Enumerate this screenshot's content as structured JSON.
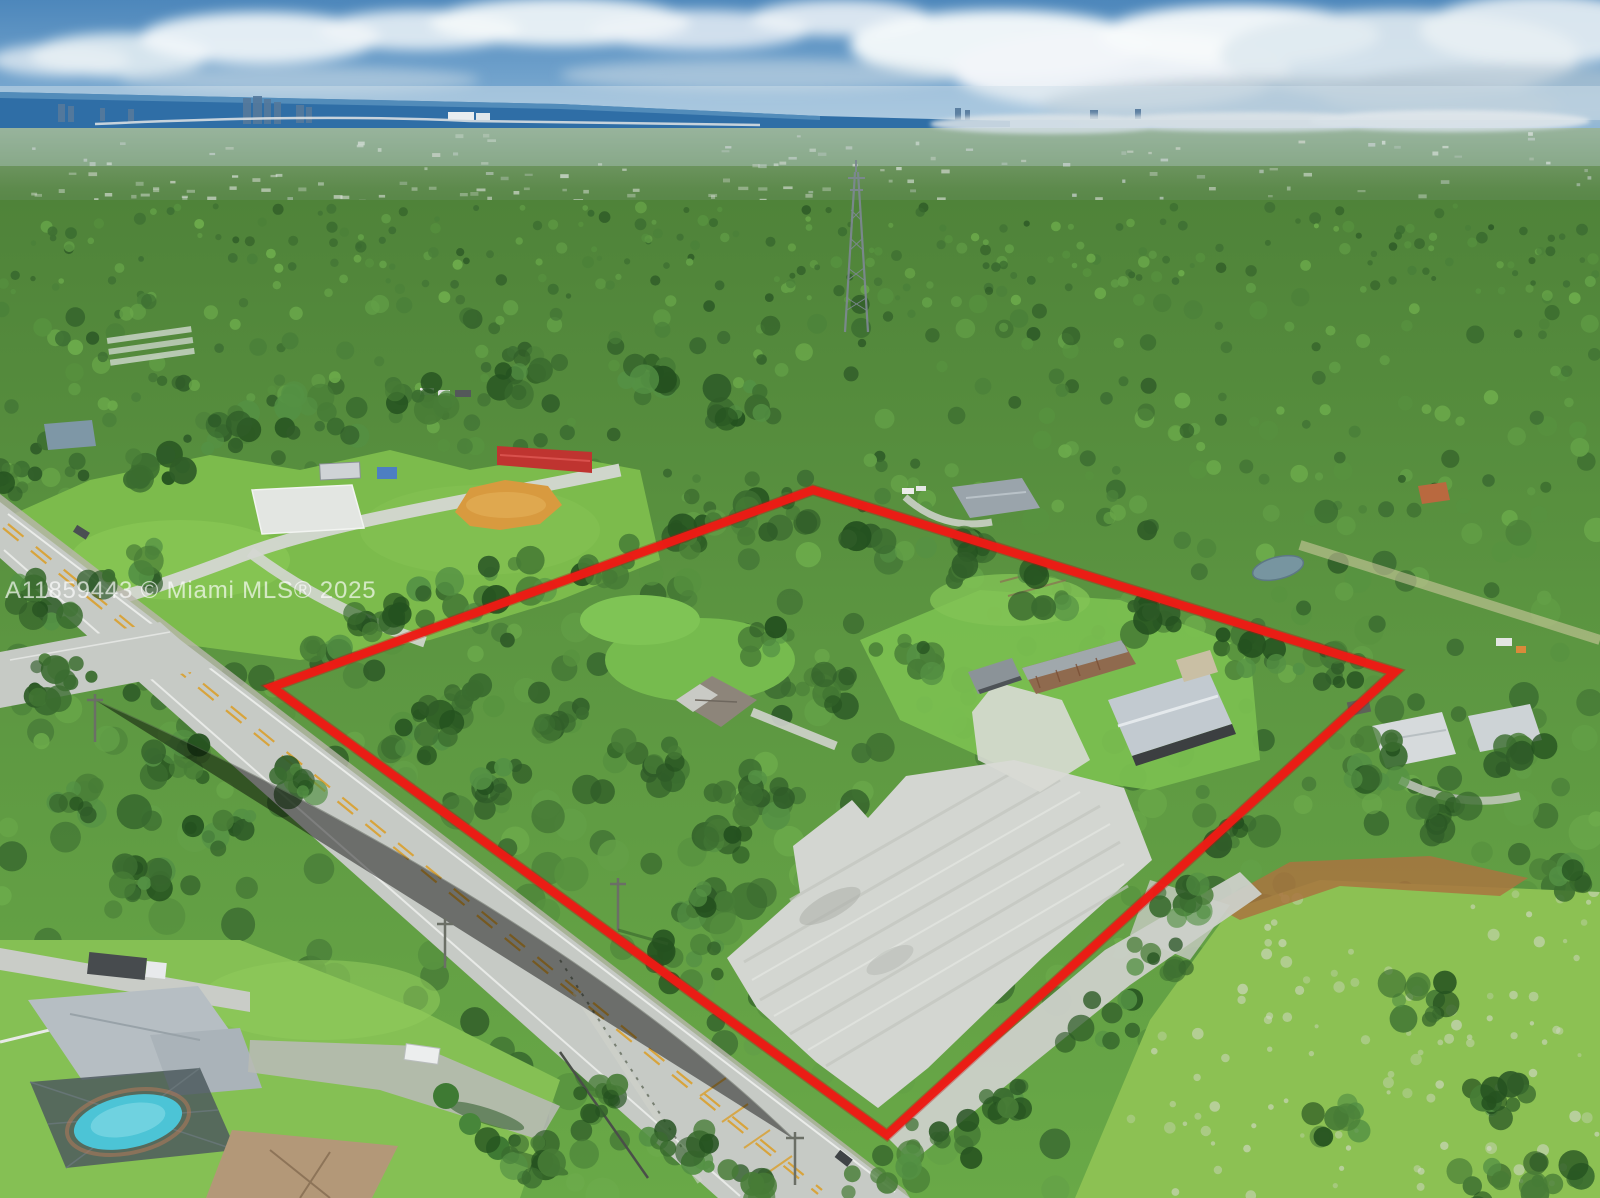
{
  "watermark": {
    "text": "A11859443 © Miami MLS® 2025"
  },
  "scene": {
    "boundary_color": "#ed1b15",
    "boundary_shadow": "#b81210",
    "pool_color": "#4cc4d6",
    "water_color": "#2f6ea6",
    "sand_color": "#d3d6d1",
    "barn_red": "#bf3430",
    "infield_orange": "#d89a3f"
  }
}
